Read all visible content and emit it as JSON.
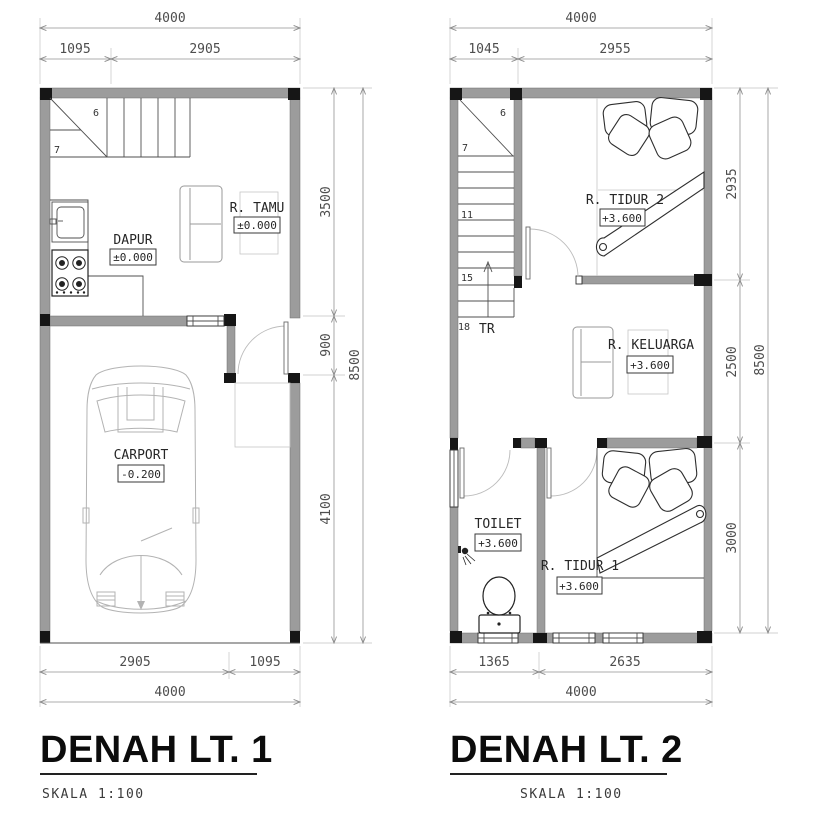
{
  "colors": {
    "wall_fill": "#9c9c9c",
    "column_fill": "#161616",
    "dim_line": "#929292",
    "dim_text": "#4d4d4d",
    "title_text": "#0c0c0c"
  },
  "plan1": {
    "title": "DENAH LT. 1",
    "scale_label": "SKALA 1:100",
    "dimensions": {
      "top_total": "4000",
      "top_segments": [
        "1095",
        "2905"
      ],
      "right_segments": [
        "3500",
        "900",
        "4100"
      ],
      "right_total": "8500",
      "bottom_segments": [
        "2905",
        "1095"
      ],
      "bottom_total": "4000"
    },
    "rooms": {
      "tamu": {
        "name": "R. TAMU",
        "level": "±0.000"
      },
      "dapur": {
        "name": "DAPUR",
        "level": "±0.000"
      },
      "carport": {
        "name": "CARPORT",
        "level": "-0.200"
      }
    },
    "stair_numbers": {
      "n6": "6",
      "n7": "7"
    }
  },
  "plan2": {
    "title": "DENAH LT. 2",
    "scale_label": "SKALA 1:100",
    "dimensions": {
      "top_total": "4000",
      "top_segments": [
        "1045",
        "2955"
      ],
      "right_segments": [
        "2935",
        "2500",
        "3000"
      ],
      "right_total": "8500",
      "bottom_segments": [
        "1365",
        "2635"
      ],
      "bottom_total": "4000"
    },
    "rooms": {
      "tidur2": {
        "name": "R. TIDUR 2",
        "level": "+3.600"
      },
      "keluarga": {
        "name": "R. KELUARGA",
        "level": "+3.600"
      },
      "toilet": {
        "name": "TOILET",
        "level": "+3.600"
      },
      "tidur1": {
        "name": "R. TIDUR 1",
        "level": "+3.600"
      }
    },
    "stair_numbers": {
      "n6": "6",
      "n7": "7",
      "n11": "11",
      "n15": "15",
      "n18": "18",
      "label": "TR"
    }
  }
}
